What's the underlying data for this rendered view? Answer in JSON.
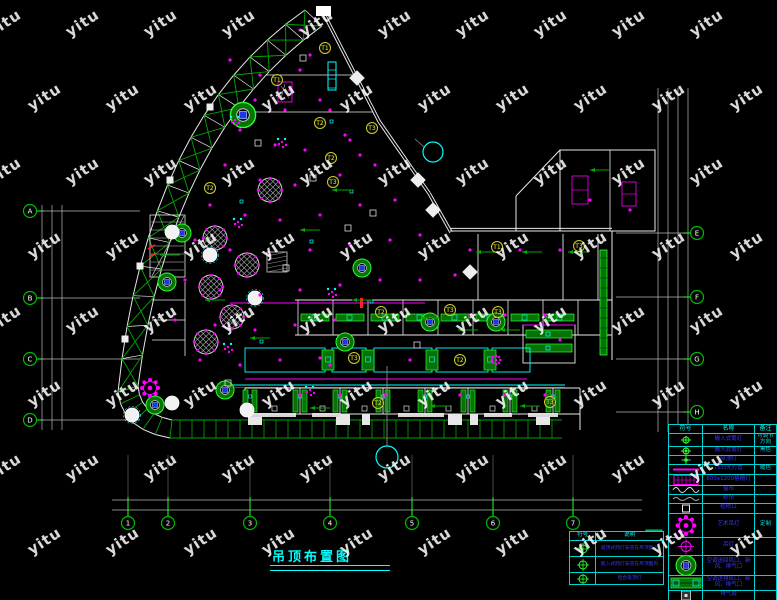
{
  "title": {
    "text": "吊顶布置图"
  },
  "watermark": {
    "text": "yitu"
  },
  "colors": {
    "background": "#000000",
    "walls": "#e8e8e8",
    "axis": "#b8b8b8",
    "green": "#00a800",
    "bright_green": "#2dff2d",
    "cyan": "#00ffff",
    "magenta": "#ff00ff",
    "yellow": "#f0f040",
    "blue_text": "#3a3aff",
    "red": "#ff2222",
    "white": "#ffffff"
  },
  "axis_bubbles": {
    "bottom": [
      "1",
      "2",
      "3",
      "4",
      "5",
      "6",
      "7"
    ],
    "left": [
      "A",
      "B",
      "C",
      "D"
    ],
    "right": [
      "E",
      "F",
      "G",
      "H"
    ]
  },
  "room_tags": [
    "T1",
    "T2",
    "T3",
    "T2",
    "T3",
    "T2",
    "T1",
    "T3",
    "T2",
    "T3",
    "T3",
    "T3",
    "T2",
    "T2",
    "T3",
    "T1"
  ],
  "legend": {
    "headers": [
      "符号",
      "名称",
      "备注"
    ],
    "rows": [
      {
        "symbol": "downlight-adjustable",
        "name": "嵌入式筒灯",
        "remark": "可调节方向"
      },
      {
        "symbol": "downlight",
        "name": "嵌入式筒灯",
        "remark": "黑色"
      },
      {
        "symbol": "ceiling-lamp",
        "name": "吸顶灯",
        "remark": ""
      },
      {
        "symbol": "t5-tube",
        "name": "T5日光灯管",
        "remark": "暖色"
      },
      {
        "symbol": "grille-light",
        "name": "600x1200格栅灯",
        "remark": ""
      },
      {
        "symbol": "curtain",
        "name": "窗帘",
        "remark": ""
      },
      {
        "symbol": "sheer-curtain",
        "name": "纱帘",
        "remark": ""
      },
      {
        "symbol": "access-panel",
        "name": "检修口",
        "remark": ""
      },
      {
        "symbol": "art-chandelier",
        "name": "艺术吊灯",
        "remark": "定制"
      },
      {
        "symbol": "pendant-lamp",
        "name": "吊灯",
        "remark": ""
      },
      {
        "symbol": "ac-round-vent",
        "name": "空调送回风口、新风、排气口",
        "remark": ""
      },
      {
        "symbol": "ac-linear-vent",
        "name": "空调送排风口、新风、排气口",
        "remark": ""
      },
      {
        "symbol": "exhaust-fan",
        "name": "排气扇",
        "remark": ""
      },
      {
        "symbol": "curtain-box",
        "name": "窗帘盒",
        "remark": "暗藏"
      }
    ]
  },
  "note_table": {
    "headers": [
      "符号",
      "说明"
    ],
    "rows": [
      {
        "symbol": "circle-cross",
        "text": "吸顶式筒灯安装在吊顶面上"
      },
      {
        "symbol": "circle-cross",
        "text": "嵌入式筒灯安装在吊顶面内"
      },
      {
        "symbol": "circle-cross",
        "text": "组合吸顶灯"
      }
    ]
  }
}
